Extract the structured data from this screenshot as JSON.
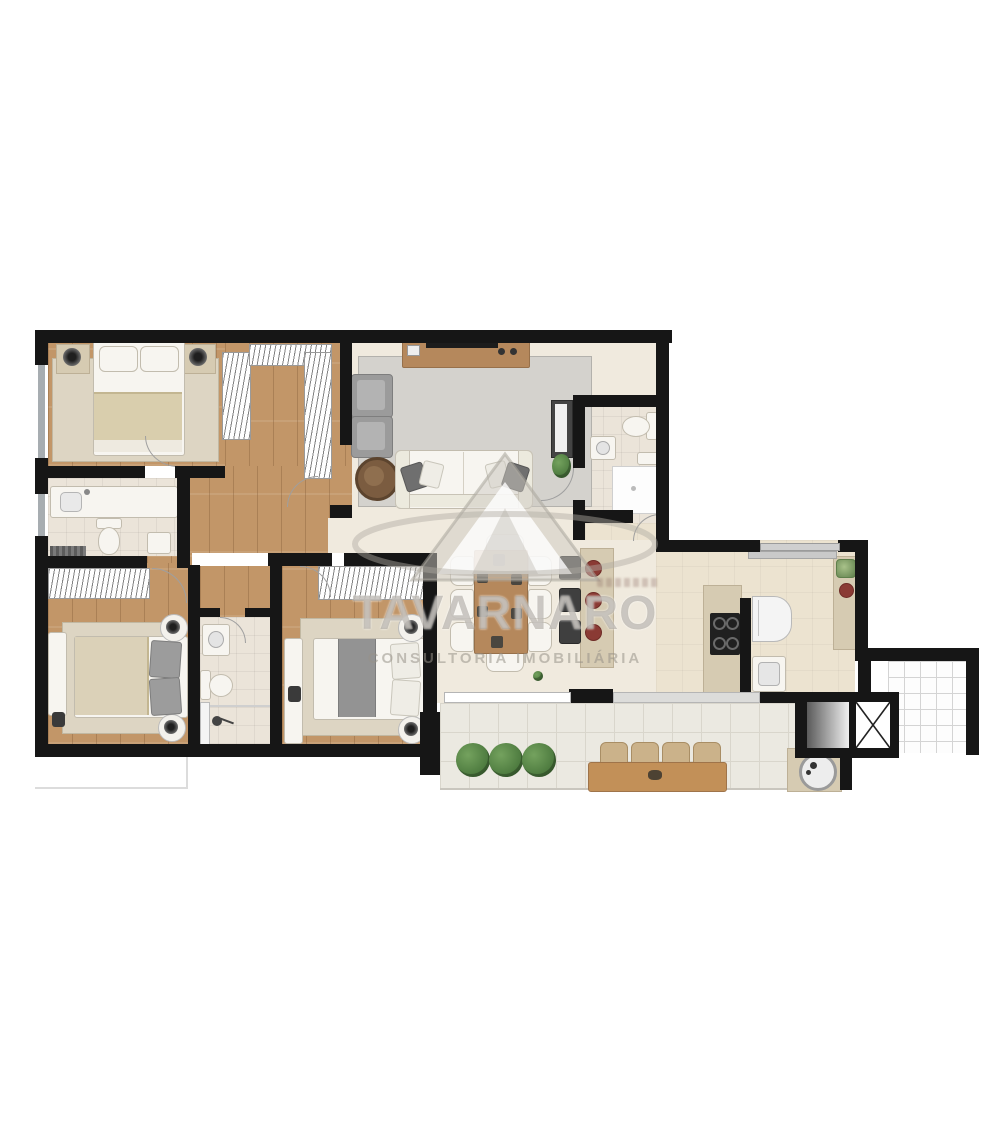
{
  "watermark": {
    "brand": "TAVARNARO",
    "tagline": "CONSULTORIA IMOBILIÁRIA",
    "logo_icon": "triangle-mountain-swoosh-logo"
  },
  "colors": {
    "wall": "#161616",
    "wood": "#c29668",
    "tile": "#f0eade",
    "ktile": "#ece3d0",
    "btile": "#ebe4d9",
    "balcony": "#ebe9e1",
    "rug_gray": "#d4d2cd",
    "rug_beige": "#ddd5c3",
    "counter": "#d6cbb2",
    "wood_furn": "#b5885c",
    "plant": "#39662f",
    "accent_red": "#8a3a34",
    "watermark_gray": "#98928 9"
  }
}
